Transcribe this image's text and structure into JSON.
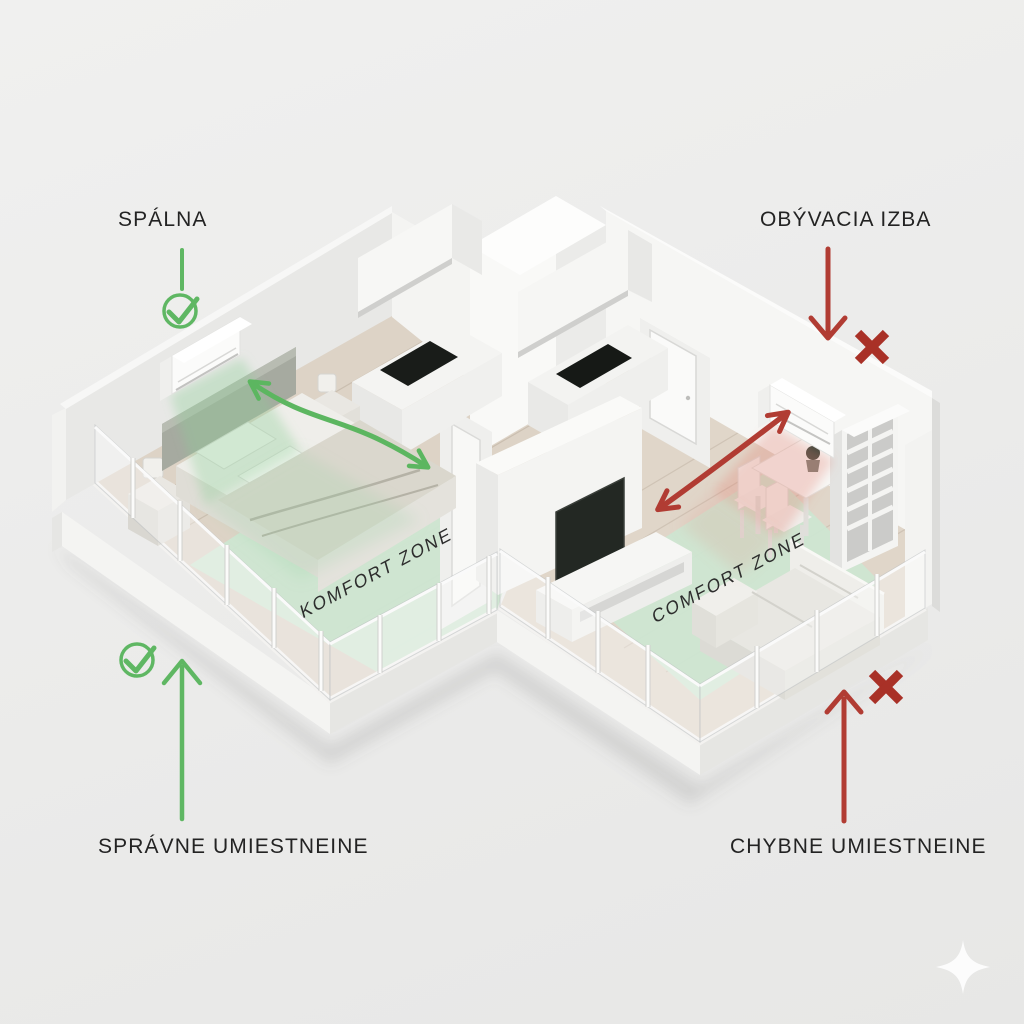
{
  "labels": {
    "bedroom": "SPÁLNA",
    "living_room": "OBÝVACIA IZBA",
    "correct_placement": "SPRÁVNE UMIESTNEINE",
    "wrong_placement": "CHYBNE UMIESTNEINE"
  },
  "floor_zones": {
    "bedroom_zone": "KOMFORT ZONE",
    "living_room_zone": "COMFORT ZONE"
  },
  "icons": {
    "bedroom_status_top": "check-circle-icon",
    "bedroom_status_bottom": "check-circle-icon",
    "living_status_top": "x-mark-icon",
    "living_status_bottom": "x-mark-icon",
    "living_pointer": "arrow-down-icon",
    "correct_pointer": "arrow-up-icon",
    "wrong_pointer": "arrow-up-icon",
    "watermark": "sparkle-icon"
  },
  "colors": {
    "background": "#ebebea",
    "accent_green": "#5fb763",
    "accent_red": "#a93127",
    "comfort_zone_green": "#cde6d2",
    "wood_floor": "#ddd3c6",
    "label_text": "#232323"
  }
}
